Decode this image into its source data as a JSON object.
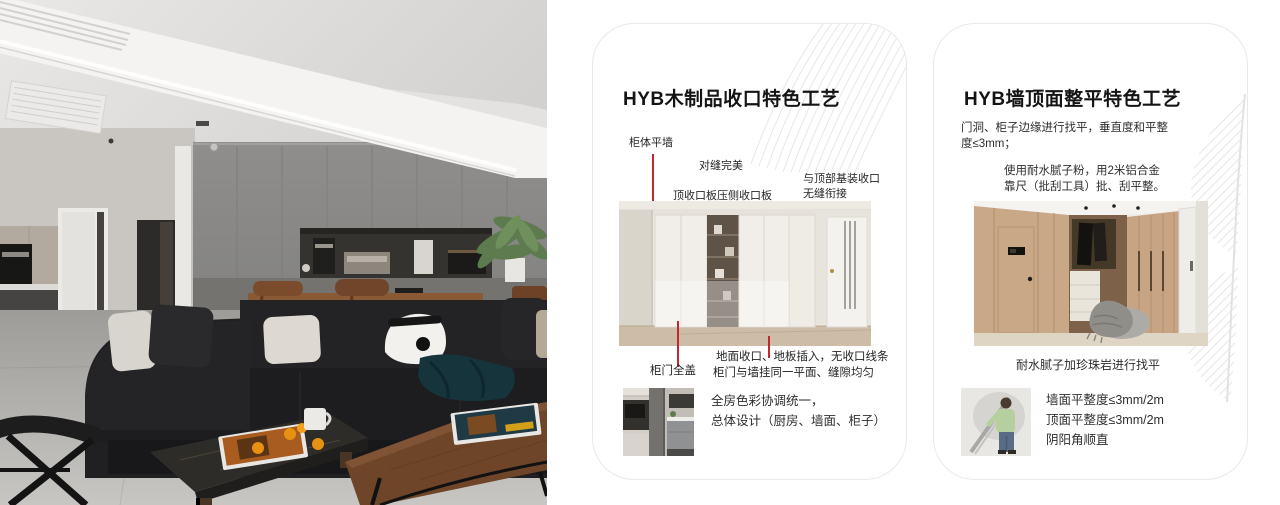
{
  "accent_red": "#c1272d",
  "cards": [
    {
      "title": "HYB木制品收口特色工艺",
      "labels": {
        "l1": "柜体平墙",
        "l2": "对缝完美",
        "l3": "顶收口板压侧收口板",
        "l4a": "与顶部基装收口",
        "l4b": "无缝衔接",
        "l5": "柜门全盖",
        "note1": "地面收口、地板插入，无收口线条",
        "note2": "柜门与墙挂同一平面、缝隙均匀",
        "sum1": "全房色彩协调统一，",
        "sum2": "总体设计（厨房、墙面、柜子）"
      }
    },
    {
      "title": "HYB墙顶面整平特色工艺",
      "p1a": "门洞、柜子边缘进行找平，垂直度和平整",
      "p1b": "度≤3mm；",
      "p2a": "使用耐水腻子粉，用2米铝合金",
      "p2b": "靠尺（批刮工具）批、刮平整。",
      "caption": "耐水腻子加珍珠岩进行找平",
      "bullets": [
        "墙面平整度≤3mm/2m",
        "顶面平整度≤3mm/2m",
        "阴阳角顺直"
      ]
    }
  ]
}
